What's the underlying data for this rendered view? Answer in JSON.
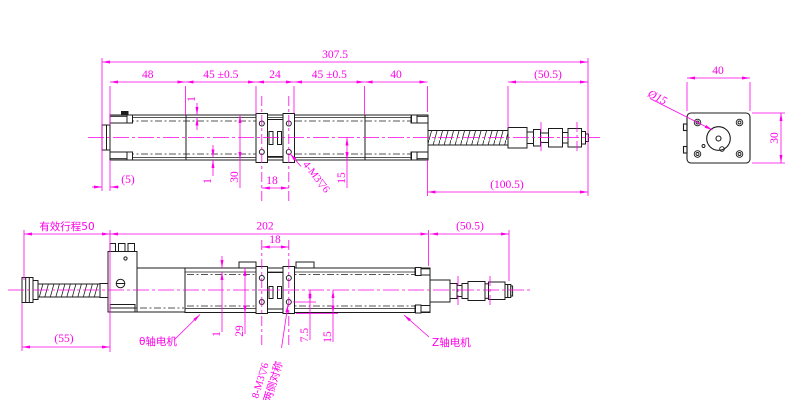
{
  "colors": {
    "dimension_magenta": "#ff00e8",
    "drawing_black": "#1c1c1c",
    "background": "#ffffff"
  },
  "top_view": {
    "dims": {
      "overall": "307.5",
      "seg_motor": "48",
      "seg_left_stage": "45 ±0.5",
      "seg_coupling": "24",
      "seg_right_stage": "45 ±0.5",
      "seg_end": "40",
      "connector": "(50.5)",
      "cable_assembly": "(100.5)",
      "stub": "(5)",
      "body_height": "30",
      "step_top": "1",
      "step_bottom": "1",
      "half_height": "15",
      "hole_pitch": "18",
      "thread_note": "4-M3▽6"
    }
  },
  "bottom_view": {
    "dims": {
      "effective_stroke": "有效行程50",
      "body_length": "202",
      "hole_pitch": "18",
      "screw_length": "(55)",
      "connector": "(50.5)",
      "step_top": "1",
      "body_height": "29",
      "hole_offset": "7.5",
      "half_height": "15",
      "thread_note": "8-M3▽6",
      "thread_note_sub": "两侧对称"
    },
    "labels": {
      "theta_motor": "θ轴电机",
      "z_motor": "Z轴电机"
    }
  },
  "end_view": {
    "dims": {
      "width": "40",
      "height": "30",
      "bore_dia": "Ø15"
    }
  }
}
